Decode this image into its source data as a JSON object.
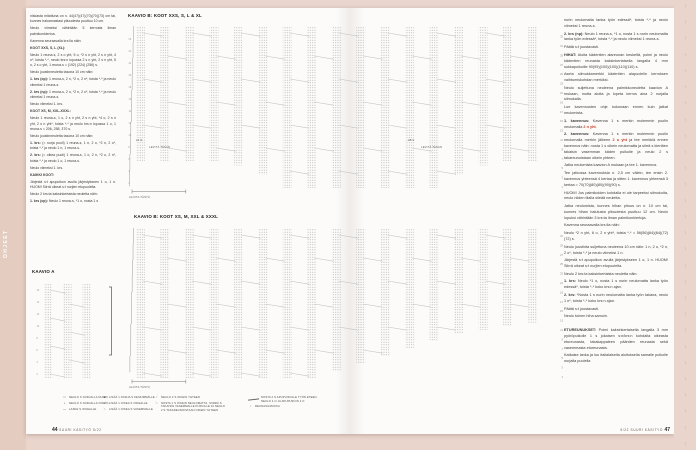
{
  "colors": {
    "background": "#e9d5cc",
    "page": "#fcfbf9",
    "accent_red": "#c63b28",
    "dot_gray": "#a8a8a8"
  },
  "sidebar": {
    "tab": "OHJEET"
  },
  "footer": {
    "left": {
      "page": "44",
      "issue": "SUURI KÄSITYÖ 5/22"
    },
    "right": {
      "issue": "5/22 SUURI KÄSITYÖ",
      "page": "47"
    }
  },
  "left_column": {
    "paragraphs": [
      {
        "text": "niskasta mitattuna on n. 44(47)(47)(70)(70)(73) cm tai, kunnes haluamastasi pituudesta puuttuu 10 cm."
      },
      {
        "text": "Neulo viimeksi vähintään 5 kerrosta ilman palmikonkiertoa."
      },
      {
        "text": "Kavenna seuraavalla krs:lla näin:"
      },
      {
        "h": "KOOT XXS, S, L (XL):"
      },
      {
        "text": "Neulo 1 reuna-s, 2 s o yht, 5 o, *2 s n yht, 2 s n yht, 4 o*, toista *-*, neulo krs:n lopussa 2 s n yht, 2 s n yht, 5 o, 2 s o yht, 1 reuna-s = (192) (224) (256) s."
      },
      {
        "text": "Neulo joustinneuletta tasona 10 cm näin:"
      },
      {
        "lead": "1. krs (op):",
        "text": " 1 reuna-s, 2 n, *2 o, 2 n*, toista *-* ja neulo viimeksi 1 reuna-s."
      },
      {
        "lead": "2. krs (np):",
        "text": " 1 reuna-s, 2 o, *2 n, 2 o*, toista *-* ja neulo viimeksi 1 reuna-s."
      },
      {
        "text": "Neulo viimeksi 1. krs."
      },
      {
        "h": "KOOT XS, M, XXL-XXXL:"
      },
      {
        "text": "Neulo 1 reuna-s, 1 o, 2 s n yht, 2 s n yht, *4 o, 2 s n yht, 2 s n yht*, toista *-* ja neulo krs:n lopussa 1 o, 1 reuna-s = 206, 258, 370 s."
      },
      {
        "text": "Neulo joustinneuletta tasona 10 cm näin:"
      },
      {
        "lead": "1. krs:",
        "text": " (= nurja puoli) 1 reuna-s, 1 n, 2 o, *2 n, 2 o*, toista *-* ja neulo 1 n, 1 reuna-s."
      },
      {
        "lead": "2. krs:",
        "text": " (= oikea puoli) 1 reuna-s, 1 o, 2 n, *2 o, 2 n*, toista *-* ja neulo 1 o, 1 reuna-s."
      },
      {
        "text": "Neulo viimeksi 1. krs."
      },
      {
        "h": "KAIKKI KOOT:"
      },
      {
        "text": "Järjestä s:t apupuikon avulla järjestykseen 1 o, 1 n. HUOM! Siirrä oikeat s:t nurjien etupuolelta."
      },
      {
        "text": "Neulo 2 krs:ta kaksinkertaista neuletta näin:"
      },
      {
        "lead": "1. krs (op):",
        "text": " Neulo 1 reuna-s, *1 o, nosta 1 s"
      }
    ]
  },
  "right_column": {
    "paragraphs": [
      {
        "text": "nurin neulomatta lanka työn edessä*, toista *-* ja neulo viimeksi 1 reuna-s."
      },
      {
        "lead": "2. krs (np):",
        "text": " Neulo 1 reuna-s, *1 o, nosta 1 s nurin neulomatta lanka työn edessä*, toista *-* ja neulo viimeksi 1 reuna-s."
      },
      {
        "text": "Päätä s:t joustavasti."
      },
      {
        "lead": "HIHAT:",
        "text": " Aloita kädentien alareunan keskeltä, poimi ja neulo kädentien reunasta kaksinkertaisella langalla 4 mm sukkapuikoille 90(95)(100)(100)(110)(110) s."
      },
      {
        "text": "Aseta silmukkamerkki kädentien alapuolelle kerroksen vaihtumiskohdan merkiksi."
      },
      {
        "text": "Neulo suljettuna neuleena palmikkoneuletta kaavion A mukaan, mutta aloita ja lopeta kerros aina 2 nurjalla silmukalla."
      },
      {
        "text": "Lue kavennusten ohje kokonaan ennen kuin jatkat neulomista."
      },
      {
        "lead": "1. kavennus:",
        "text": " Kavenna 1 s merkin molemmin puolin neulomalla ",
        "red": "2 n yht",
        "text2": "."
      },
      {
        "lead": "2. kavennus:",
        "text": " Kavenna 1 s merkin molemmin puolin neulomalla merkin jälkeen ",
        "red": "2 o yht",
        "text2": " ja tee merkkiä ennen kavennus näin: nosta 1 s oikein neulomatta ja siirrä s kiertäen takaisin vasemman käden puikolle ja neulo 2 s takareunoistaan oikein yhteen."
      },
      {
        "text": "Jatka neulomista kaavion A mukaan ja tee 1. kavennus."
      },
      {
        "text": "Tee jatkossa kavennuksia n. 2,5 cm välein, tee ensin 2. kavennus yhteensä 4 kertaa ja sitten 1. kavennus yhteensä 3 kertaa = 70(70)(80)(80)(90)(90) s."
      },
      {
        "text": "HUOM! Jos palmikoiden kohdalla ei ole tarpeeksi silmukoita, neulo niiden tilalla sileää neuletta."
      },
      {
        "text": "Jatka neulomista, kunnes hihan pituus on n. 10 cm tai, kunnes hihan halutusta pituudesta puuttuu 12 cm. Neulo lopuksi vähintään 3 krs:ta ilman palmikonkiertoja."
      },
      {
        "text": "Kavenna seuraavalla krs:lla näin:"
      },
      {
        "text": "Neulo *2 n yht, 6 o, 2 n yht*, toista *-* = 56(56)(64)(64)(72)(72) s."
      },
      {
        "text": "Neulo joustinta suljettuna neuleena 10 cm näin: 1 n, 2 o, *2 n, 2 o*, toista *-* ja neulo viimeksi 1 n."
      },
      {
        "text": "Järjestä s:t apupuikon avulla järjestykseen 1 o, 1 n. HUOM! Siirrä oikeat s:t nurjien etupuolelta."
      },
      {
        "text": "Neulo 2 krs:ta kaksinkertaista neuletta näin:"
      },
      {
        "lead": "1. krs:",
        "text": " Neulo *1 o, nosta 1 s nurin neulomatta lanka työn edessä*, toista *-* koko krs:n ajan."
      },
      {
        "lead": "2. krs:",
        "text": " *Nosta 1 s nurin neulomatta lanka työn takana, neulo 1 n*, toista *-* koko krs:n ajan."
      },
      {
        "text": "Päätä s:t joustavasti."
      },
      {
        "text": "Neulo toinen hiha samoin."
      },
      {
        "gap": true,
        "lead": "ETUREUNUKSET:",
        "text": " Poimi kaksinkertaisella langalla 3 mm pyöröpuikolle 1 s jokaisen s:n/krs:n kohdalta oikeasta etureunasta, takakappaleen pääntien reunasta sekä vasemmasta etureunasta."
      },
      {
        "text": "Katkaise lanka ja luo italialaisella aloituksella samalle puikolle nurjalla puolella"
      }
    ]
  },
  "charts": [
    {
      "title": "KAAVIO B: KOOT XXS, S, L & XL",
      "type": "knitting-cable-chart",
      "bands": 17,
      "twist_step": 46,
      "heights": [
        0.84,
        0.84,
        0.84,
        0.84,
        0.86,
        0.92,
        1,
        1,
        1,
        1,
        1,
        1,
        1,
        0.92,
        0.86,
        0.84,
        0.84
      ],
      "labels": {
        "start": "ALOITA TÄSTÄ",
        "spread": "LEVITÄ TASAN",
        "count_left": "24 S",
        "count_right": "28 S"
      }
    },
    {
      "title": "KAAVIO B: KOOT XS, M, XXL & XXXL",
      "type": "knitting-cable-chart",
      "bands": 17,
      "twist_step": 46,
      "heights": [
        1,
        1,
        1,
        1,
        1,
        1,
        1,
        1,
        0.95,
        0.9,
        0.85,
        0.8,
        0.75,
        0.7,
        0.68,
        0.65,
        0.63
      ],
      "labels": {
        "start": "ALOITA TÄSTÄ",
        "spread": "LEVITÄ TASAN"
      }
    },
    {
      "title": "KAAVIO A",
      "type": "knitting-cable-chart",
      "bands": 3,
      "twist_step": 28,
      "heights": [
        1,
        1,
        1
      ],
      "labels": {}
    }
  ],
  "legend": {
    "groups": [
      {
        "items": [
          {
            "sym": "□",
            "lines": [
              "NEULO S NURJALLA NURIN"
            ]
          },
          {
            "sym": "•",
            "lines": [
              "NEULO S NURJALLA OIKEIN"
            ]
          },
          {
            "sym": "—",
            "lines": [
              "LASKE S OIKEALLE"
            ]
          }
        ]
      },
      {
        "items": [
          {
            "sym": "●",
            "lines": [
              "LISÄÄ 1 NURJA S KESKIMMÄLLE"
            ]
          },
          {
            "sym": "⟋",
            "lines": [
              "LISÄÄ 1 OIKEA S OIKEALLE"
            ]
          },
          {
            "sym": "⟍",
            "lines": [
              "LISÄÄ 1 OIKEA S VASEMMALLE"
            ]
          }
        ]
      },
      {
        "items": [
          {
            "sym": "⟋",
            "lines": [
              "NEULO 2 S OIKEIN YHTEEN"
            ]
          },
          {
            "sym": "⟍",
            "lines": [
              "NOSTA 1 S OIKEIN NEULOMATTA, SIIRRÄ S",
              "TAKAISIN VASEMMALLE PUIKOLLE JA NEULO",
              "2 S TAKAREUNOISTAAN OIKEIN YHTEEN"
            ]
          }
        ]
      },
      {
        "items": [
          {
            "sym": "cable",
            "lines": [
              "NOSTA 2 S APUPUIKOLLE TYÖN ETEEN,",
              "NEULO 4 O JA APUPUIKON 2 O"
            ]
          },
          {
            "sym": "▫",
            "lines": [
              "REUNASILMUKKA"
            ]
          }
        ]
      }
    ]
  }
}
